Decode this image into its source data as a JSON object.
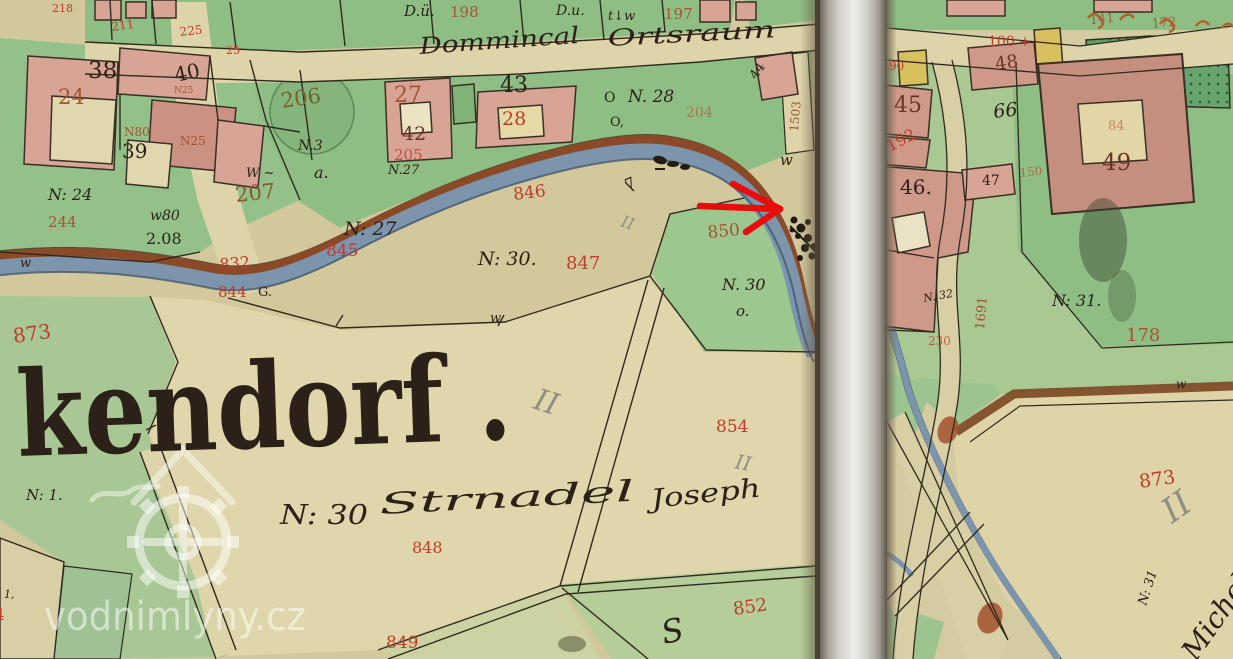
{
  "title": "Historical cadastral map scan, two sheets, with red locator arrow (watermill site)",
  "map": {
    "colors": {
      "ink": "#2b2118",
      "red": "#bf3b2a",
      "brick": "#a8532f",
      "brown": "#8a5a2a",
      "olive": "#75622a",
      "darkred": "#6b3226",
      "pencil": "#8e8e86",
      "white": "rgba(255,255,255,0.52)",
      "river": "#7d95ac",
      "bank": "#8a4a28"
    },
    "annotation": {
      "type": "arrow",
      "color": "#e70d0d"
    },
    "labels": [
      {
        "name": "lbl-218",
        "text": "218",
        "x": 52,
        "y": 12,
        "size": 11,
        "color": "red"
      },
      {
        "name": "lbl-211",
        "text": "211",
        "x": 112,
        "y": 31,
        "size": 12,
        "color": "red",
        "rot": -8
      },
      {
        "name": "lbl-225",
        "text": "225",
        "x": 180,
        "y": 36,
        "size": 12,
        "color": "red",
        "rot": -6
      },
      {
        "name": "lbl-25",
        "text": "25",
        "x": 226,
        "y": 54,
        "size": 11,
        "color": "red"
      },
      {
        "name": "lbl-du1",
        "text": "D.ü.",
        "x": 404,
        "y": 16,
        "size": 15,
        "color": "ink",
        "cls": "script"
      },
      {
        "name": "lbl-198",
        "text": "198",
        "x": 450,
        "y": 17,
        "size": 15,
        "color": "brick"
      },
      {
        "name": "lbl-du2",
        "text": "D.u.",
        "x": 556,
        "y": 15,
        "size": 14,
        "color": "ink",
        "cls": "script"
      },
      {
        "name": "lbl-tw",
        "text": "t↓w",
        "x": 608,
        "y": 20,
        "size": 13,
        "color": "ink",
        "cls": "script"
      },
      {
        "name": "lbl-197",
        "text": "197",
        "x": 664,
        "y": 19,
        "size": 15,
        "color": "brick"
      },
      {
        "name": "lbl-dommincal",
        "text": "Dommincal",
        "x": 420,
        "y": 54,
        "size": 23,
        "color": "ink",
        "cls": "script",
        "rot": -4,
        "len": 160
      },
      {
        "name": "lbl-ortsraum",
        "text": "Ortsraum",
        "x": 608,
        "y": 46,
        "size": 23,
        "color": "ink",
        "cls": "script",
        "rot": -3,
        "len": 168
      },
      {
        "name": "lbl-38",
        "text": "38",
        "x": 88,
        "y": 78,
        "size": 23,
        "color": "ink"
      },
      {
        "name": "lbl-24",
        "text": "24",
        "x": 58,
        "y": 104,
        "size": 21,
        "color": "brick"
      },
      {
        "name": "lbl-40",
        "text": "40",
        "x": 176,
        "y": 82,
        "size": 20,
        "color": "ink",
        "rot": -12
      },
      {
        "name": "lbl-n25a",
        "text": "N25",
        "x": 174,
        "y": 93,
        "size": 9,
        "color": "brick"
      },
      {
        "name": "lbl-39",
        "text": "39",
        "x": 122,
        "y": 158,
        "size": 20,
        "color": "ink"
      },
      {
        "name": "lbl-n80",
        "text": "N80",
        "x": 124,
        "y": 136,
        "size": 12,
        "color": "brick"
      },
      {
        "name": "lbl-n25b",
        "text": "N25",
        "x": 180,
        "y": 145,
        "size": 12,
        "color": "brick"
      },
      {
        "name": "lbl-w-dash",
        "text": "W ~",
        "x": 246,
        "y": 177,
        "size": 13,
        "color": "ink",
        "cls": "script"
      },
      {
        "name": "lbl-207",
        "text": "207",
        "x": 236,
        "y": 202,
        "size": 21,
        "color": "brown",
        "rot": -6
      },
      {
        "name": "lbl-n24",
        "text": "N: 24",
        "x": 48,
        "y": 200,
        "size": 16,
        "color": "ink",
        "cls": "script"
      },
      {
        "name": "lbl-244",
        "text": "244",
        "x": 48,
        "y": 227,
        "size": 15,
        "color": "brick"
      },
      {
        "name": "lbl-w80",
        "text": "w80",
        "x": 150,
        "y": 220,
        "size": 14,
        "color": "ink",
        "cls": "script"
      },
      {
        "name": "lbl-208",
        "text": "2.08",
        "x": 146,
        "y": 244,
        "size": 16,
        "color": "ink"
      },
      {
        "name": "lbl-w-left",
        "text": "w",
        "x": 20,
        "y": 267,
        "size": 13,
        "color": "ink",
        "cls": "script"
      },
      {
        "name": "lbl-832",
        "text": "832",
        "x": 220,
        "y": 270,
        "size": 16,
        "color": "red",
        "rot": -5
      },
      {
        "name": "lbl-844",
        "text": "844",
        "x": 218,
        "y": 297,
        "size": 15,
        "color": "red"
      },
      {
        "name": "lbl-844g",
        "text": "G.",
        "x": 258,
        "y": 296,
        "size": 13,
        "color": "ink"
      },
      {
        "name": "lbl-873-left",
        "text": "873",
        "x": 14,
        "y": 343,
        "size": 20,
        "color": "red",
        "rot": -8
      },
      {
        "name": "lbl-206",
        "text": "206",
        "x": 282,
        "y": 108,
        "size": 21,
        "color": "olive",
        "rot": -8
      },
      {
        "name": "lbl-n3",
        "text": "N.3",
        "x": 298,
        "y": 150,
        "size": 14,
        "color": "ink",
        "cls": "script"
      },
      {
        "name": "lbl-a",
        "text": "a.",
        "x": 314,
        "y": 178,
        "size": 16,
        "color": "ink",
        "cls": "script"
      },
      {
        "name": "lbl-27",
        "text": "27",
        "x": 394,
        "y": 102,
        "size": 22,
        "color": "brick"
      },
      {
        "name": "lbl-42",
        "text": "42",
        "x": 402,
        "y": 140,
        "size": 19,
        "color": "darkred"
      },
      {
        "name": "lbl-43",
        "text": "43",
        "x": 500,
        "y": 92,
        "size": 22,
        "color": "ink"
      },
      {
        "name": "lbl-28",
        "text": "28",
        "x": 502,
        "y": 125,
        "size": 19,
        "color": "red"
      },
      {
        "name": "lbl-205",
        "text": "205",
        "x": 394,
        "y": 160,
        "size": 15,
        "color": "red",
        "op": 0.8
      },
      {
        "name": "lbl-n27a",
        "text": "N.27",
        "x": 388,
        "y": 174,
        "size": 13,
        "color": "ink",
        "cls": "script"
      },
      {
        "name": "lbl-o1",
        "text": "O",
        "x": 604,
        "y": 102,
        "size": 14,
        "color": "ink"
      },
      {
        "name": "lbl-n28",
        "text": "N. 28",
        "x": 628,
        "y": 102,
        "size": 17,
        "color": "ink",
        "cls": "script"
      },
      {
        "name": "lbl-o2",
        "text": "O,",
        "x": 610,
        "y": 126,
        "size": 13,
        "color": "ink"
      },
      {
        "name": "lbl-204",
        "text": "204",
        "x": 686,
        "y": 117,
        "size": 14,
        "color": "red",
        "op": 0.55
      },
      {
        "name": "lbl-44",
        "text": "44",
        "x": 756,
        "y": 80,
        "size": 13,
        "color": "ink",
        "rot": -55
      },
      {
        "name": "lbl-1503",
        "text": "1503",
        "x": 798,
        "y": 132,
        "size": 12,
        "color": "brick",
        "rot": -85
      },
      {
        "name": "lbl-w-mill",
        "text": "w",
        "x": 780,
        "y": 165,
        "size": 15,
        "color": "ink",
        "cls": "script"
      },
      {
        "name": "lbl-7tick",
        "text": "7",
        "x": 628,
        "y": 190,
        "size": 15,
        "color": "ink",
        "rot": -25
      },
      {
        "name": "lbl-n27b",
        "text": "N: 27",
        "x": 344,
        "y": 235,
        "size": 19,
        "color": "ink",
        "cls": "script"
      },
      {
        "name": "lbl-845",
        "text": "845",
        "x": 326,
        "y": 256,
        "size": 17,
        "color": "red"
      },
      {
        "name": "lbl-846",
        "text": "846",
        "x": 514,
        "y": 200,
        "size": 17,
        "color": "red",
        "rot": -7
      },
      {
        "name": "lbl-n30a",
        "text": "N: 30.",
        "x": 478,
        "y": 265,
        "size": 19,
        "color": "ink",
        "cls": "script"
      },
      {
        "name": "lbl-847",
        "text": "847",
        "x": 566,
        "y": 269,
        "size": 18,
        "color": "red"
      },
      {
        "name": "lbl-850",
        "text": "850",
        "x": 708,
        "y": 238,
        "size": 17,
        "color": "brick",
        "rot": -5
      },
      {
        "name": "lbl-n30b",
        "text": "N. 30",
        "x": 722,
        "y": 290,
        "size": 16,
        "color": "ink",
        "cls": "script"
      },
      {
        "name": "lbl-o3",
        "text": "o.",
        "x": 736,
        "y": 316,
        "size": 15,
        "color": "ink",
        "cls": "script"
      },
      {
        "name": "lbl-ii-a",
        "text": "II",
        "x": 620,
        "y": 226,
        "size": 16,
        "color": "pencil",
        "rot": 18,
        "cls": "script"
      },
      {
        "name": "lbl-ii-b",
        "text": "II",
        "x": 532,
        "y": 408,
        "size": 30,
        "color": "pencil",
        "rot": 18,
        "cls": "script"
      },
      {
        "name": "lbl-854",
        "text": "854",
        "x": 716,
        "y": 432,
        "size": 17,
        "color": "red"
      },
      {
        "name": "lbl-ii-c",
        "text": "II",
        "x": 734,
        "y": 468,
        "size": 20,
        "color": "pencil",
        "rot": 12,
        "cls": "script"
      },
      {
        "name": "lbl-kendorf",
        "text": "kendorf .",
        "x": 18,
        "y": 456,
        "size": 118,
        "color": "ink",
        "cls": "big",
        "rot": -2,
        "len": 495
      },
      {
        "name": "lbl-n1",
        "text": "N: 1.",
        "x": 26,
        "y": 500,
        "size": 15,
        "color": "ink",
        "cls": "script"
      },
      {
        "name": "lbl-n30-big",
        "text": "N: 30",
        "x": 280,
        "y": 524,
        "size": 27,
        "color": "ink",
        "cls": "script",
        "len": 88
      },
      {
        "name": "lbl-strnadel",
        "text": "Strnadel",
        "x": 380,
        "y": 514,
        "size": 29,
        "color": "ink",
        "cls": "script",
        "rot": -3,
        "len": 255
      },
      {
        "name": "lbl-joseph",
        "text": "Joseph",
        "x": 652,
        "y": 508,
        "size": 26,
        "color": "ink",
        "cls": "script",
        "rot": -6,
        "len": 110
      },
      {
        "name": "lbl-848",
        "text": "848",
        "x": 412,
        "y": 553,
        "size": 16,
        "color": "red"
      },
      {
        "name": "lbl-849",
        "text": "849",
        "x": 386,
        "y": 648,
        "size": 17,
        "color": "red"
      },
      {
        "name": "lbl-852",
        "text": "852",
        "x": 734,
        "y": 615,
        "size": 18,
        "color": "red",
        "rot": -8
      },
      {
        "name": "lbl-s-script",
        "text": "S",
        "x": 664,
        "y": 644,
        "size": 32,
        "color": "ink",
        "cls": "script",
        "rot": -12
      },
      {
        "name": "lbl-844-frag",
        "text": "844",
        "x": -26,
        "y": 620,
        "size": 16,
        "color": "red"
      },
      {
        "name": "lbl-1comma",
        "text": "1,",
        "x": 4,
        "y": 598,
        "size": 11,
        "color": "ink",
        "cls": "script"
      },
      {
        "name": "lbl-w-field",
        "text": "w",
        "x": 490,
        "y": 322,
        "size": 13,
        "color": "ink",
        "cls": "script"
      },
      {
        "name": "lbl-100",
        "text": "100 +",
        "x": 988,
        "y": 46,
        "size": 14,
        "color": "red"
      },
      {
        "name": "lbl-48",
        "text": "48",
        "x": 996,
        "y": 70,
        "size": 18,
        "color": "darkred",
        "rot": -8
      },
      {
        "name": "lbl-90",
        "text": "90",
        "x": 889,
        "y": 70,
        "size": 12,
        "color": "red"
      },
      {
        "name": "lbl-45",
        "text": "45",
        "x": 894,
        "y": 112,
        "size": 22,
        "color": "darkred"
      },
      {
        "name": "lbl-66",
        "text": "66",
        "x": 994,
        "y": 118,
        "size": 19,
        "color": "ink",
        "rot": -6,
        "cls": "script"
      },
      {
        "name": "lbl-192",
        "text": "192",
        "x": 890,
        "y": 152,
        "size": 16,
        "color": "red",
        "rot": -28
      },
      {
        "name": "lbl-49",
        "text": "49",
        "x": 1102,
        "y": 170,
        "size": 23,
        "color": "darkred"
      },
      {
        "name": "lbl-84",
        "text": "84",
        "x": 1108,
        "y": 130,
        "size": 13,
        "color": "red",
        "op": 0.55
      },
      {
        "name": "lbl-46",
        "text": "46.",
        "x": 900,
        "y": 194,
        "size": 20,
        "color": "ink"
      },
      {
        "name": "lbl-47",
        "text": "47",
        "x": 982,
        "y": 185,
        "size": 14,
        "color": "ink"
      },
      {
        "name": "lbl-150",
        "text": "150",
        "x": 1020,
        "y": 177,
        "size": 12,
        "color": "red",
        "op": 0.65,
        "rot": -6
      },
      {
        "name": "lbl-1691",
        "text": "1691",
        "x": 984,
        "y": 330,
        "size": 13,
        "color": "brick",
        "rot": -85
      },
      {
        "name": "lbl-n32",
        "text": "N. 32",
        "x": 924,
        "y": 302,
        "size": 11,
        "color": "ink",
        "cls": "script",
        "rot": -10
      },
      {
        "name": "lbl-230",
        "text": "230",
        "x": 928,
        "y": 345,
        "size": 12,
        "color": "red",
        "op": 0.75
      },
      {
        "name": "lbl-n31",
        "text": "N: 31.",
        "x": 1052,
        "y": 306,
        "size": 16,
        "color": "ink",
        "cls": "script"
      },
      {
        "name": "lbl-178",
        "text": "178",
        "x": 1126,
        "y": 341,
        "size": 18,
        "color": "brick"
      },
      {
        "name": "lbl-873-right",
        "text": "873",
        "x": 1140,
        "y": 488,
        "size": 19,
        "color": "red",
        "rot": -8
      },
      {
        "name": "lbl-ii-right",
        "text": "II",
        "x": 1172,
        "y": 524,
        "size": 34,
        "color": "pencil",
        "rot": -35,
        "cls": "script"
      },
      {
        "name": "lbl-n31-rot",
        "text": "N: 31",
        "x": 1146,
        "y": 606,
        "size": 13,
        "color": "ink",
        "cls": "script",
        "rot": -72
      },
      {
        "name": "lbl-michel",
        "text": "Michel",
        "x": 1196,
        "y": 662,
        "size": 28,
        "color": "ink",
        "cls": "script",
        "rot": -55
      },
      {
        "name": "lbl-w-right",
        "text": "w",
        "x": 1176,
        "y": 388,
        "size": 12,
        "color": "ink",
        "cls": "script"
      },
      {
        "name": "lbl-141",
        "text": "141",
        "x": 1090,
        "y": 24,
        "size": 13,
        "color": "brick",
        "op": 0.85,
        "rot": -5
      },
      {
        "name": "lbl-172",
        "text": "172",
        "x": 1152,
        "y": 28,
        "size": 13,
        "color": "brick",
        "op": 0.85,
        "rot": -5
      },
      {
        "name": "watermark-text",
        "text": "vodnimlyny.cz",
        "x": 44,
        "y": 630,
        "size": 40,
        "color": "white",
        "cls": "wm",
        "len": 262
      }
    ]
  }
}
